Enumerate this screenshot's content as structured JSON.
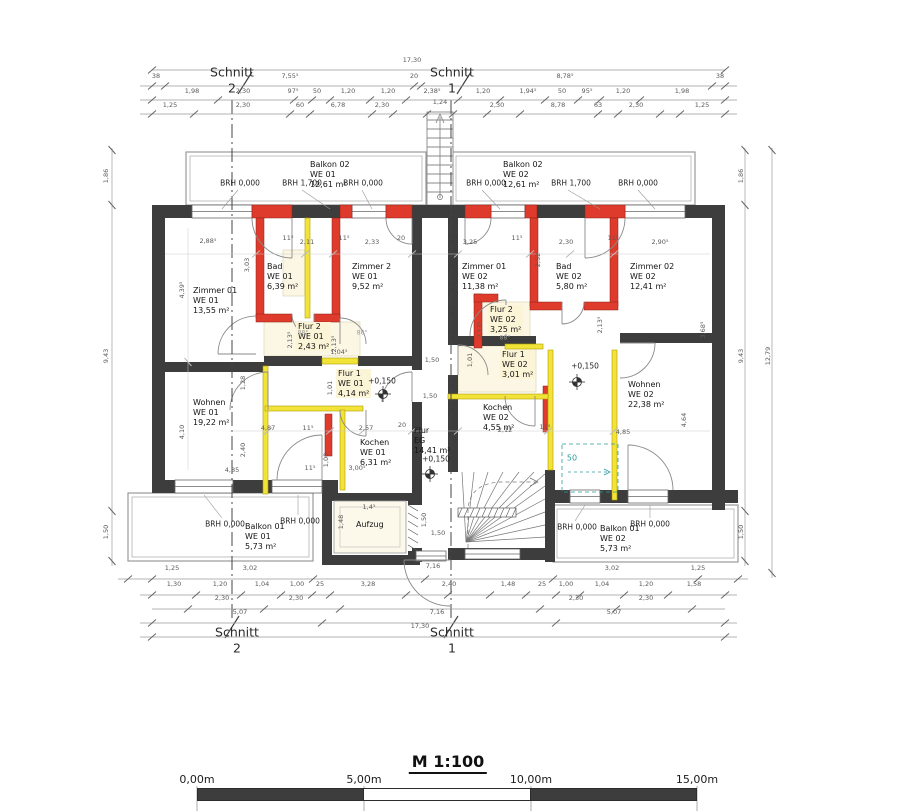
{
  "colors": {
    "wall": "#3d3d3d",
    "new_wall_red": "#df3b2c",
    "demolition_yellow": "#f2e339",
    "teal": "#2e9b9b",
    "dim_line": "#9a9a9a"
  },
  "sections": {
    "tl": {
      "word": "Schnitt",
      "num": "2"
    },
    "tr": {
      "word": "Schnitt",
      "num": "1"
    },
    "bl": {
      "word": "Schnitt",
      "num": "2"
    },
    "br": {
      "word": "Schnitt",
      "num": "1"
    }
  },
  "rooms": [
    {
      "name": "Zimmer 01",
      "unit": "WE 01",
      "area": "13,55 m²",
      "x": 193,
      "y": 286
    },
    {
      "name": "Bad",
      "unit": "WE 01",
      "area": "6,39 m²",
      "x": 267,
      "y": 262
    },
    {
      "name": "Zimmer 2",
      "unit": "WE 01",
      "area": "9,52 m²",
      "x": 352,
      "y": 262
    },
    {
      "name": "Zimmer 01",
      "unit": "WE 02",
      "area": "11,38 m²",
      "x": 462,
      "y": 262
    },
    {
      "name": "Bad",
      "unit": "WE 02",
      "area": "5,80 m²",
      "x": 556,
      "y": 262
    },
    {
      "name": "Zimmer 02",
      "unit": "WE 02",
      "area": "12,41 m²",
      "x": 630,
      "y": 262
    },
    {
      "name": "Flur 2",
      "unit": "WE 01",
      "area": "2,43 m²",
      "x": 296,
      "y": 322,
      "cls": "hl"
    },
    {
      "name": "Flur 2",
      "unit": "WE 02",
      "area": "3,25 m²",
      "x": 488,
      "y": 305,
      "cls": "hl"
    },
    {
      "name": "Flur 1",
      "unit": "WE 01",
      "area": "4,14 m²",
      "x": 336,
      "y": 369,
      "cls": "hl"
    },
    {
      "name": "Flur 1",
      "unit": "WE 02",
      "area": "3,01 m²",
      "x": 500,
      "y": 350,
      "cls": "hl"
    },
    {
      "name": "Wohnen",
      "unit": "WE 01",
      "area": "19,22 m²",
      "x": 193,
      "y": 398
    },
    {
      "name": "Wohnen",
      "unit": "WE 02",
      "area": "22,38 m²",
      "x": 628,
      "y": 380
    },
    {
      "name": "Kochen",
      "unit": "WE 01",
      "area": "6,31 m²",
      "x": 360,
      "y": 438
    },
    {
      "name": "Kochen",
      "unit": "WE 02",
      "area": "4,55 m²",
      "x": 483,
      "y": 403
    },
    {
      "name": "Balkon 02",
      "unit": "WE 01",
      "area": "12,61 m²",
      "x": 310,
      "y": 160
    },
    {
      "name": "Balkon 02",
      "unit": "WE 02",
      "area": "12,61 m²",
      "x": 503,
      "y": 160
    },
    {
      "name": "Balkon 01",
      "unit": "WE 01",
      "area": "5,73 m²",
      "x": 245,
      "y": 522
    },
    {
      "name": "Balkon 01",
      "unit": "WE 02",
      "area": "5,73 m²",
      "x": 600,
      "y": 524
    },
    {
      "name": "Flur",
      "unit": "EG",
      "area": "14,41 m²",
      "x": 414,
      "y": 426
    },
    {
      "name": "Aufzug",
      "x": 356,
      "y": 520
    }
  ],
  "brh_labels": [
    {
      "text": "BRH 0,000",
      "x": 240,
      "y": 183
    },
    {
      "text": "BRH 1,700",
      "x": 302,
      "y": 183
    },
    {
      "text": "BRH 0,000",
      "x": 363,
      "y": 183
    },
    {
      "text": "BRH 0,000",
      "x": 486,
      "y": 183
    },
    {
      "text": "BRH 1,700",
      "x": 571,
      "y": 183
    },
    {
      "text": "BRH 0,000",
      "x": 638,
      "y": 183
    },
    {
      "text": "BRH 0,000",
      "x": 225,
      "y": 524
    },
    {
      "text": "BRH 0,000",
      "x": 300,
      "y": 521
    },
    {
      "text": "BRH 0,000",
      "x": 577,
      "y": 527
    },
    {
      "text": "BRH 0,000",
      "x": 650,
      "y": 524
    }
  ],
  "level_marks": [
    {
      "text": "+0,150",
      "x": 382,
      "y": 381
    },
    {
      "text": "+0,150",
      "x": 585,
      "y": 366
    },
    {
      "text": "+0,150",
      "x": 436,
      "y": 459
    }
  ],
  "misc_labels": [
    {
      "text": "50",
      "x": 572,
      "y": 458,
      "cls": "teal"
    }
  ],
  "dims": [
    {
      "t": "17,30",
      "x": 412,
      "y": 60
    },
    {
      "t": "38",
      "x": 156,
      "y": 76
    },
    {
      "t": "7,55⁵",
      "x": 290,
      "y": 76
    },
    {
      "t": "20",
      "x": 414,
      "y": 76
    },
    {
      "t": "8,78⁵",
      "x": 565,
      "y": 76
    },
    {
      "t": "38",
      "x": 720,
      "y": 76
    },
    {
      "t": "1,98",
      "x": 192,
      "y": 91
    },
    {
      "t": "2,30",
      "x": 243,
      "y": 91
    },
    {
      "t": "97⁵",
      "x": 293,
      "y": 91
    },
    {
      "t": "50",
      "x": 317,
      "y": 91
    },
    {
      "t": "1,20",
      "x": 348,
      "y": 91
    },
    {
      "t": "1,20",
      "x": 388,
      "y": 91
    },
    {
      "t": "2,38⁵",
      "x": 432,
      "y": 91
    },
    {
      "t": "1,20",
      "x": 483,
      "y": 91
    },
    {
      "t": "1,94⁵",
      "x": 528,
      "y": 91
    },
    {
      "t": "50",
      "x": 562,
      "y": 91
    },
    {
      "t": "95⁵",
      "x": 587,
      "y": 91
    },
    {
      "t": "1,20",
      "x": 623,
      "y": 91
    },
    {
      "t": "1,98",
      "x": 682,
      "y": 91
    },
    {
      "t": "1,25",
      "x": 170,
      "y": 105
    },
    {
      "t": "2,30",
      "x": 243,
      "y": 105
    },
    {
      "t": "60",
      "x": 300,
      "y": 105
    },
    {
      "t": "6,78",
      "x": 338,
      "y": 105
    },
    {
      "t": "2,30",
      "x": 382,
      "y": 105
    },
    {
      "t": "1,24",
      "x": 440,
      "y": 102
    },
    {
      "t": "2,30",
      "x": 497,
      "y": 105
    },
    {
      "t": "8,78",
      "x": 558,
      "y": 105
    },
    {
      "t": "63",
      "x": 598,
      "y": 105
    },
    {
      "t": "2,30",
      "x": 636,
      "y": 105
    },
    {
      "t": "1,25",
      "x": 702,
      "y": 105
    },
    {
      "t": "1,86",
      "x": 106,
      "y": 176,
      "r": 1
    },
    {
      "t": "9,43",
      "x": 106,
      "y": 356,
      "r": 1
    },
    {
      "t": "1,50",
      "x": 106,
      "y": 532,
      "r": 1
    },
    {
      "t": "4,39⁵",
      "x": 182,
      "y": 290,
      "r": 1
    },
    {
      "t": "4,10",
      "x": 182,
      "y": 432,
      "r": 1
    },
    {
      "t": "1,86",
      "x": 741,
      "y": 176,
      "r": 1
    },
    {
      "t": "9,43",
      "x": 741,
      "y": 356,
      "r": 1
    },
    {
      "t": "1,50",
      "x": 741,
      "y": 532,
      "r": 1
    },
    {
      "t": "12,79",
      "x": 768,
      "y": 356,
      "r": 1
    },
    {
      "t": "2,88⁵",
      "x": 208,
      "y": 241
    },
    {
      "t": "11⁵",
      "x": 288,
      "y": 238
    },
    {
      "t": "2,11",
      "x": 307,
      "y": 242
    },
    {
      "t": "11⁵",
      "x": 344,
      "y": 238
    },
    {
      "t": "2,33",
      "x": 372,
      "y": 242
    },
    {
      "t": "20",
      "x": 401,
      "y": 238
    },
    {
      "t": "3,25",
      "x": 470,
      "y": 242
    },
    {
      "t": "11⁵",
      "x": 517,
      "y": 238
    },
    {
      "t": "2,30",
      "x": 566,
      "y": 242
    },
    {
      "t": "11⁵",
      "x": 613,
      "y": 238
    },
    {
      "t": "2,90⁵",
      "x": 660,
      "y": 242
    },
    {
      "t": "3,03",
      "x": 247,
      "y": 265,
      "r": 1
    },
    {
      "t": "2,52",
      "x": 538,
      "y": 260,
      "r": 1
    },
    {
      "t": "3,68⁵",
      "x": 703,
      "y": 330,
      "r": 1
    },
    {
      "t": "1,28",
      "x": 243,
      "y": 383,
      "r": 1
    },
    {
      "t": "2,40",
      "x": 243,
      "y": 450,
      "r": 1
    },
    {
      "t": "4,87",
      "x": 268,
      "y": 428
    },
    {
      "t": "11⁵",
      "x": 308,
      "y": 428
    },
    {
      "t": "2,57",
      "x": 366,
      "y": 428
    },
    {
      "t": "20",
      "x": 402,
      "y": 425
    },
    {
      "t": "11⁵",
      "x": 310,
      "y": 468
    },
    {
      "t": "1,00",
      "x": 326,
      "y": 460,
      "r": 1
    },
    {
      "t": "3,00⁵",
      "x": 357,
      "y": 468
    },
    {
      "t": "4,85",
      "x": 232,
      "y": 470
    },
    {
      "t": "2,12",
      "x": 505,
      "y": 430
    },
    {
      "t": "11⁵",
      "x": 545,
      "y": 427
    },
    {
      "t": "4,85",
      "x": 623,
      "y": 432
    },
    {
      "t": "4,64",
      "x": 684,
      "y": 420,
      "r": 1
    },
    {
      "t": "1,04⁵",
      "x": 339,
      "y": 352
    },
    {
      "t": "2,13⁵",
      "x": 290,
      "y": 340,
      "r": 1
    },
    {
      "t": "2,13⁵",
      "x": 334,
      "y": 344,
      "r": 1
    },
    {
      "t": "2,13⁵",
      "x": 480,
      "y": 330,
      "r": 1
    },
    {
      "t": "2,13⁵",
      "x": 600,
      "y": 325,
      "r": 1
    },
    {
      "t": "1,01",
      "x": 330,
      "y": 388,
      "r": 1
    },
    {
      "t": "1,01",
      "x": 470,
      "y": 360,
      "r": 1
    },
    {
      "t": "88°",
      "x": 303,
      "y": 333,
      "cls": "ang"
    },
    {
      "t": "88°",
      "x": 362,
      "y": 333,
      "cls": "ang"
    },
    {
      "t": "88°",
      "x": 505,
      "y": 338,
      "cls": "ang"
    },
    {
      "t": "1,50",
      "x": 432,
      "y": 360
    },
    {
      "t": "1,50",
      "x": 430,
      "y": 396
    },
    {
      "t": "1,50",
      "x": 424,
      "y": 520,
      "r": 1
    },
    {
      "t": "1,50",
      "x": 438,
      "y": 533
    },
    {
      "t": "1,4⁵",
      "x": 369,
      "y": 507
    },
    {
      "t": "1,48",
      "x": 341,
      "y": 522,
      "r": 1
    },
    {
      "t": "1,25",
      "x": 172,
      "y": 568
    },
    {
      "t": "3,02",
      "x": 250,
      "y": 568
    },
    {
      "t": "7,16",
      "x": 433,
      "y": 566
    },
    {
      "t": "3,02",
      "x": 612,
      "y": 568
    },
    {
      "t": "1,25",
      "x": 698,
      "y": 568
    },
    {
      "t": "1,30",
      "x": 174,
      "y": 584
    },
    {
      "t": "1,20",
      "x": 220,
      "y": 584
    },
    {
      "t": "1,04",
      "x": 262,
      "y": 584
    },
    {
      "t": "1,00",
      "x": 297,
      "y": 584
    },
    {
      "t": "25",
      "x": 320,
      "y": 584
    },
    {
      "t": "3,28",
      "x": 368,
      "y": 584
    },
    {
      "t": "2,40",
      "x": 449,
      "y": 584
    },
    {
      "t": "1,48",
      "x": 508,
      "y": 584
    },
    {
      "t": "25",
      "x": 542,
      "y": 584
    },
    {
      "t": "1,00",
      "x": 566,
      "y": 584
    },
    {
      "t": "1,04",
      "x": 602,
      "y": 584
    },
    {
      "t": "1,20",
      "x": 646,
      "y": 584
    },
    {
      "t": "1,58",
      "x": 694,
      "y": 584
    },
    {
      "t": "2,30",
      "x": 222,
      "y": 598
    },
    {
      "t": "2,30",
      "x": 296,
      "y": 598
    },
    {
      "t": "2,30",
      "x": 576,
      "y": 598
    },
    {
      "t": "2,30",
      "x": 646,
      "y": 598
    },
    {
      "t": "5,07",
      "x": 240,
      "y": 612
    },
    {
      "t": "7,16",
      "x": 437,
      "y": 612
    },
    {
      "t": "5,07",
      "x": 614,
      "y": 612
    },
    {
      "t": "17,30",
      "x": 420,
      "y": 626
    }
  ],
  "scale_bar": {
    "title": "M 1:100",
    "labels": [
      "0,00m",
      "5,00m",
      "10,00m",
      "15,00m"
    ]
  }
}
